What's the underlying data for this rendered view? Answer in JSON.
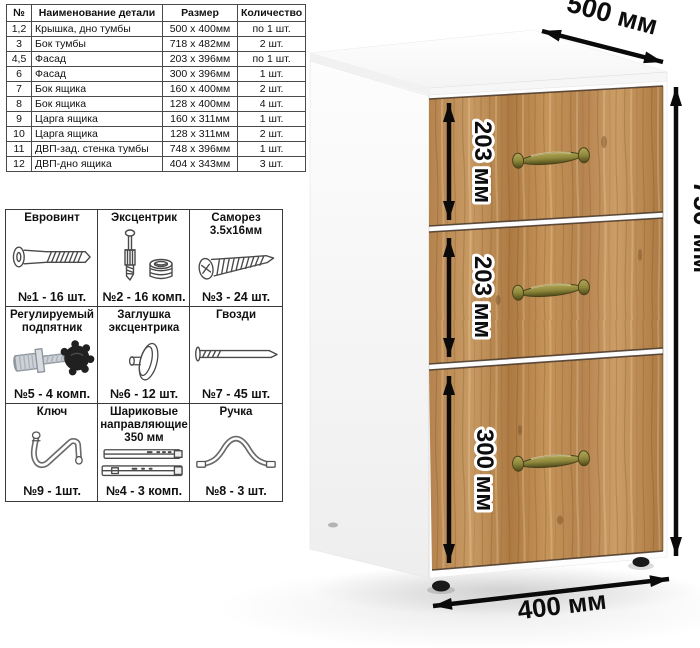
{
  "parts_table": {
    "headers": [
      "№",
      "Наименование детали",
      "Размер",
      "Количество"
    ],
    "rows": [
      [
        "1,2",
        "Крышка, дно тумбы",
        "500 x 400мм",
        "по 1 шт."
      ],
      [
        "3",
        "Бок тумбы",
        "718 x 482мм",
        "2 шт."
      ],
      [
        "4,5",
        "Фасад",
        "203 x 396мм",
        "по 1 шт."
      ],
      [
        "6",
        "Фасад",
        "300 x 396мм",
        "1 шт."
      ],
      [
        "7",
        "Бок ящика",
        "160 x 400мм",
        "2 шт."
      ],
      [
        "8",
        "Бок ящика",
        "128 x 400мм",
        "4 шт."
      ],
      [
        "9",
        "Царга ящика",
        "160 x 311мм",
        "1 шт."
      ],
      [
        "10",
        "Царга ящика",
        "128 x 311мм",
        "2 шт."
      ],
      [
        "11",
        "ДВП-зад. стенка тумбы",
        "748 x 396мм",
        "1 шт."
      ],
      [
        "12",
        "ДВП-дно ящика",
        "404 x 343мм",
        "3 шт."
      ]
    ]
  },
  "hardware": {
    "items": [
      {
        "title": "Евровинт",
        "icon": "euro-screw-icon",
        "count": "№1 - 16 шт."
      },
      {
        "title": "Эксцентрик",
        "icon": "cam-lock-icon",
        "count": "№2 - 16 комп."
      },
      {
        "title": "Саморез 3.5х16мм",
        "icon": "self-tapping-screw-icon",
        "count": "№3 - 24 шт."
      },
      {
        "title": "Регулируемый подпятник",
        "icon": "adjustable-foot-icon",
        "count": "№5 - 4 комп."
      },
      {
        "title": "Заглушка эксцентрика",
        "icon": "cam-cover-icon",
        "count": "№6 - 12 шт."
      },
      {
        "title": "Гвозди",
        "icon": "nail-icon",
        "count": "№7 - 45 шт."
      },
      {
        "title": "Ключ",
        "icon": "hex-key-icon",
        "count": "№9 - 1шт."
      },
      {
        "title": "Шариковые направляющие 350 мм",
        "icon": "ball-slides-icon",
        "count": "№4 - 3 комп."
      },
      {
        "title": "Ручка",
        "icon": "bow-handle-icon",
        "count": "№8 - 3 шт."
      }
    ]
  },
  "cabinet": {
    "drawer_count": 3,
    "dimensions": {
      "width": "500 мм",
      "height": "750 мм",
      "depth": "400 мм",
      "drawer_top": "203 мм",
      "drawer_middle": "203 мм",
      "drawer_bottom": "300 мм"
    },
    "colors": {
      "wood": "#bd8a55",
      "wood_dark": "#9a6a38",
      "wood_light": "#d2a26b",
      "handle_brass": "#8f883c",
      "body_white": "#ffffff",
      "dimension_text": "#0d0d0d"
    }
  }
}
